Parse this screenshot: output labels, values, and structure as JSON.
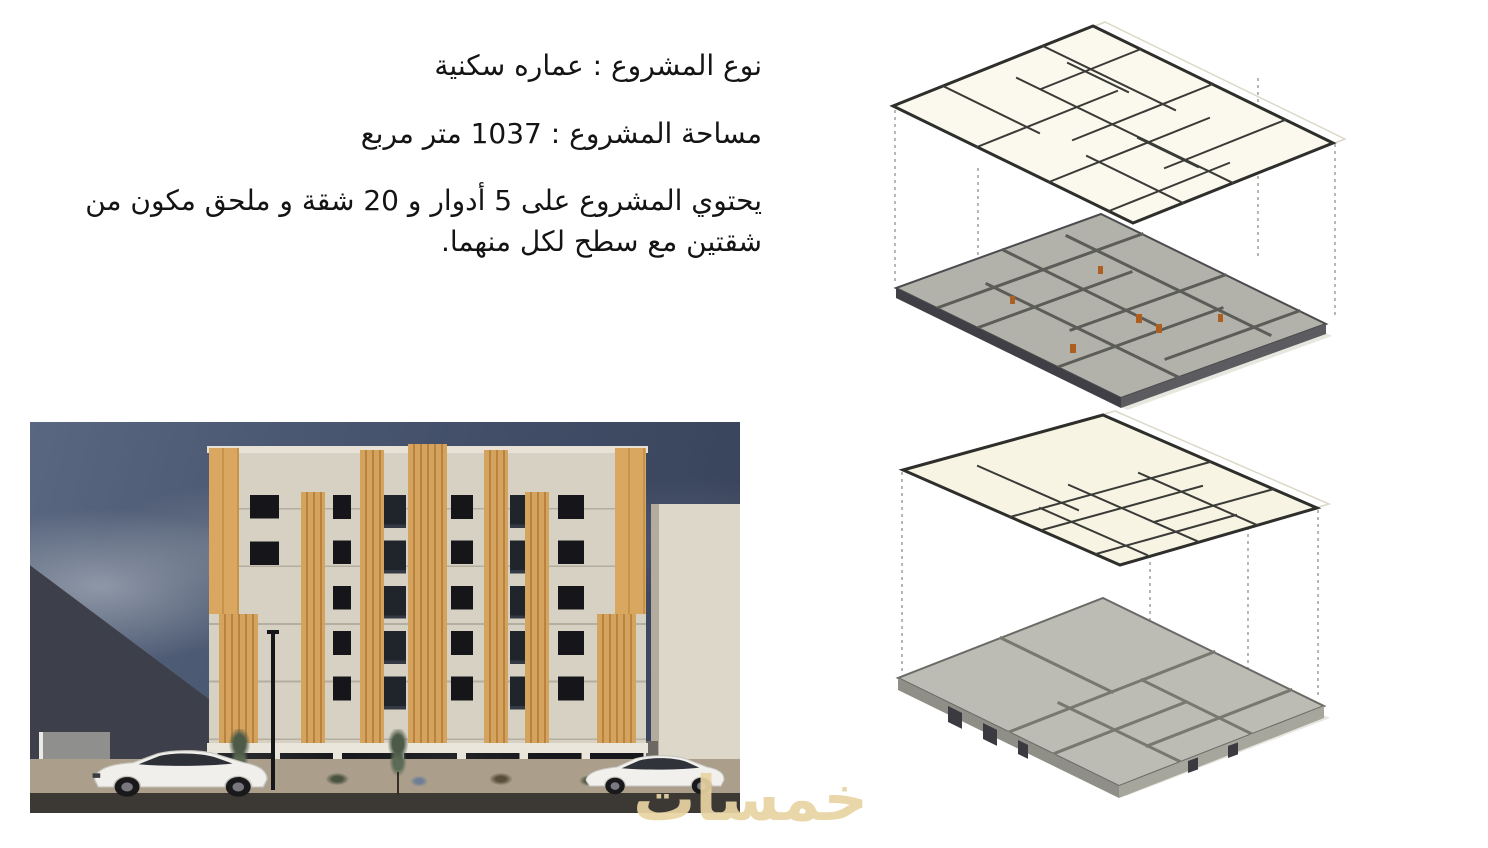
{
  "document": {
    "language": "ar",
    "direction": "rtl"
  },
  "project_info": {
    "type_line": "نوع المشروع : عماره سكنية",
    "area_line": "مساحة المشروع : 1037 متر مربع",
    "description_line": "يحتوي المشروع على 5 أدوار و 20 شقة و ملحق مكون من شقتين مع سطح لكل منهما."
  },
  "watermark": {
    "text": "خمسات",
    "color": "#e9d4a2"
  },
  "palette": {
    "page_background": "#ffffff",
    "text": "#141414",
    "wood_accent": "#d4a35e",
    "facade": "#d7d1c3",
    "sky": "#47536a",
    "window_dark": "#16161a",
    "plan_paper": "#fbf9ee",
    "model_gray_dark": "#b2b2aa",
    "model_gray_light": "#bcbcb4",
    "door_orange": "#ad5f22",
    "road": "#3c3834"
  }
}
